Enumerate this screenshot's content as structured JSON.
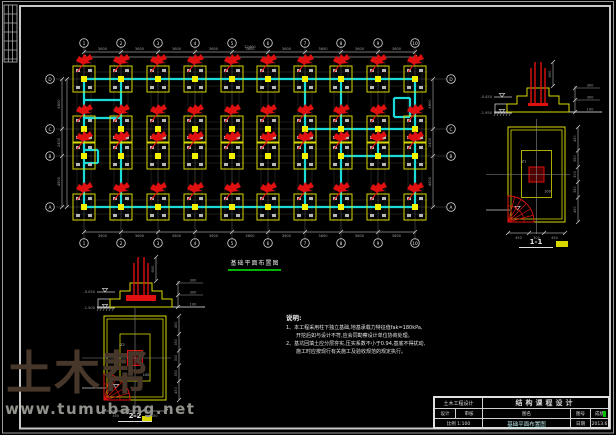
{
  "page": {
    "bg": "#000000"
  },
  "colors": {
    "beam": "#1adada",
    "footing": "#d9d900",
    "column": "#f2f200",
    "rebar": "#e01010",
    "dim": "#9b9b9b",
    "grid": "#555555",
    "frame": "#c8c8c8",
    "green": "#00b400",
    "text": "#e0e0e0"
  },
  "watermark": {
    "brand": "土木帮",
    "url": "www.tumubang.net"
  },
  "plan": {
    "title": "基础平面布置图",
    "scale": "1:100",
    "axes": {
      "cols": {
        "labels": [
          "1",
          "2",
          "3",
          "4",
          "5",
          "6",
          "7",
          "8",
          "9",
          "10"
        ],
        "x": [
          84,
          121,
          158,
          195,
          232,
          268,
          305,
          341,
          378,
          415
        ]
      },
      "rows": {
        "labels": [
          "D",
          "C",
          "B",
          "A"
        ],
        "y": [
          79,
          129,
          156,
          207
        ]
      }
    },
    "dims": {
      "top": [
        "3600",
        "3600",
        "3600",
        "3600",
        "3600",
        "3600",
        "3600",
        "3600",
        "3600"
      ],
      "top_overall": "32400",
      "bottom": [
        "3600",
        "3600",
        "3600",
        "3600",
        "3600",
        "3600",
        "3600",
        "3600",
        "3600"
      ],
      "left": [
        "4800",
        "2400",
        "4800"
      ],
      "right": [
        "4800",
        "2400",
        "4800"
      ]
    },
    "beams": [
      [
        84,
        79,
        415,
        79
      ],
      [
        84,
        207,
        415,
        207
      ],
      [
        84,
        79,
        84,
        207
      ],
      [
        415,
        79,
        415,
        207
      ],
      [
        121,
        79,
        121,
        207
      ],
      [
        305,
        79,
        305,
        207
      ],
      [
        341,
        79,
        341,
        207
      ],
      [
        305,
        129,
        415,
        129
      ],
      [
        341,
        156,
        415,
        156
      ],
      [
        378,
        129,
        378,
        156
      ],
      [
        84,
        100,
        121,
        100
      ],
      [
        84,
        118,
        121,
        118
      ],
      [
        84,
        150,
        98,
        150
      ],
      [
        84,
        163,
        98,
        163
      ],
      [
        98,
        150,
        98,
        163
      ],
      [
        394,
        98,
        410,
        98
      ],
      [
        394,
        117,
        410,
        117
      ],
      [
        394,
        98,
        394,
        117
      ],
      [
        410,
        98,
        410,
        117
      ]
    ]
  },
  "details": {
    "right_section": {
      "elevations": [
        "-0.450",
        "-1.950"
      ],
      "leader_texts": [
        "300",
        "300",
        "100"
      ],
      "bar_dim": "600"
    },
    "right_plan": {
      "label": "1-1",
      "right_dims": [
        "450",
        "350",
        "300",
        "350",
        "450"
      ],
      "bottom_dims": [
        "450",
        "300",
        "450"
      ],
      "inner_labels": [
        "JZ1",
        "100"
      ]
    },
    "bottom_section": {
      "elevations": [
        "-0.050",
        "-1.500"
      ],
      "leader_texts": [
        "300",
        "300",
        "100"
      ],
      "bar_dim": "600"
    },
    "bottom_plan": {
      "label": "2-2",
      "right_dims": [
        "450",
        "350",
        "300",
        "350",
        "450"
      ],
      "bottom_dims": [
        "450",
        "300",
        "450"
      ],
      "inner_labels": [
        "JZ2",
        "100"
      ]
    }
  },
  "notes": {
    "title": "说明:",
    "lines": [
      "1、本工程采用柱下独立基础,地基承载力特征值fak=180kPa,",
      "　　开挖后如与设计不符,应会同勘察设计单位协商处理。",
      "2、基坑回填土应分层夯实,压实系数不小于0.94,基底不得扰动,",
      "　　施工时应按现行有关施工及验收规范的规定执行。"
    ]
  },
  "title_block": {
    "project": "土木工程设计",
    "main_title": "结构课程设计",
    "design": "设计",
    "check": "审核",
    "fig_name": "图名",
    "fig_no": "图号",
    "grade": "成绩",
    "scale": "比例 1:100",
    "drawing_name": "基础平面布置图",
    "date_label": "日期",
    "date_value": "2013.6"
  }
}
